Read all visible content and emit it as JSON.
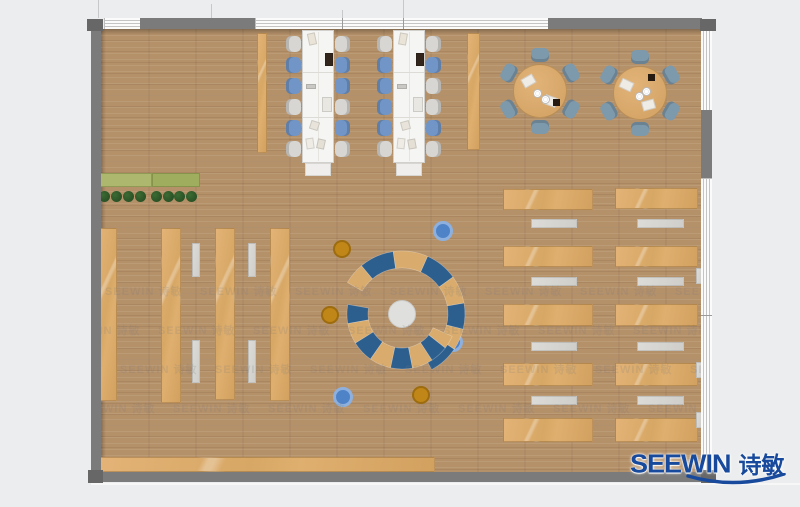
{
  "logo": {
    "text_en": "SEEWIN",
    "text_cn": "诗敏"
  },
  "watermark": {
    "text": "SEEWIN 诗敏",
    "step": 95,
    "count": 8,
    "rows": [
      {
        "y": 283,
        "x0": 10
      },
      {
        "y": 322,
        "x0": 63
      },
      {
        "y": 361,
        "x0": 25
      },
      {
        "y": 400,
        "x0": 78
      }
    ]
  },
  "colors": {
    "background": "#ecedee",
    "wall": "#7b7b7b",
    "wall_dark": "#676767",
    "window": "#fbfbfb",
    "window_line": "#c4c4c4",
    "floor": "#b5916a",
    "furniture_tan": "#dcab6d",
    "furniture_gray": "#d6d5d1",
    "table_white": "#f5f5f3",
    "table_border": "#d2d0cc",
    "chair_gray": "#d7d6d2",
    "chair_blue": "#7095c6",
    "round_chair_blue": "#7d99ac",
    "arc_blue": "#2d5f8e",
    "arc_tan": "#d9ab6c",
    "hub_gray": "#dfdfdd",
    "ottoman_blue": "#4f83c7",
    "ottoman_orange": "#c08617",
    "planter_green": "#a8b56c",
    "plant_green": "#2a5226",
    "logo_blue": "#17499c",
    "watermark_gray": "#7a7a7a"
  },
  "furniture": {
    "rects": [
      {
        "name": "side-bench",
        "x": 257,
        "y": 33,
        "w": 10,
        "h": 120
      },
      {
        "name": "side-bench",
        "x": 467,
        "y": 33,
        "w": 13,
        "h": 117
      },
      {
        "name": "bookshelf",
        "x": 98,
        "y": 228,
        "w": 19,
        "h": 173
      },
      {
        "name": "bookshelf",
        "x": 161,
        "y": 228,
        "w": 20,
        "h": 175
      },
      {
        "name": "bookshelf",
        "x": 215,
        "y": 228,
        "w": 20,
        "h": 172
      },
      {
        "name": "bookshelf",
        "x": 270,
        "y": 228,
        "w": 20,
        "h": 173
      },
      {
        "name": "desk-row",
        "x": 503,
        "y": 189,
        "w": 90,
        "h": 21
      },
      {
        "name": "desk-row",
        "x": 503,
        "y": 246,
        "w": 90,
        "h": 21
      },
      {
        "name": "desk-row",
        "x": 503,
        "y": 304,
        "w": 90,
        "h": 22
      },
      {
        "name": "desk-row",
        "x": 503,
        "y": 363,
        "w": 90,
        "h": 23
      },
      {
        "name": "desk-row",
        "x": 503,
        "y": 418,
        "w": 90,
        "h": 24
      },
      {
        "name": "desk-row",
        "x": 615,
        "y": 188,
        "w": 83,
        "h": 21
      },
      {
        "name": "desk-row",
        "x": 615,
        "y": 246,
        "w": 83,
        "h": 21
      },
      {
        "name": "desk-row",
        "x": 615,
        "y": 304,
        "w": 83,
        "h": 22
      },
      {
        "name": "desk-row",
        "x": 615,
        "y": 363,
        "w": 83,
        "h": 23
      },
      {
        "name": "desk-row",
        "x": 615,
        "y": 418,
        "w": 83,
        "h": 24
      },
      {
        "name": "bottom-bench",
        "x": 100,
        "y": 457,
        "w": 335,
        "h": 15
      }
    ],
    "gray_rects": [
      {
        "name": "reading-bench",
        "x": 192,
        "y": 243,
        "w": 8,
        "h": 34
      },
      {
        "name": "reading-bench",
        "x": 192,
        "y": 340,
        "w": 8,
        "h": 43
      },
      {
        "name": "reading-bench",
        "x": 248,
        "y": 243,
        "w": 8,
        "h": 34
      },
      {
        "name": "reading-bench",
        "x": 248,
        "y": 340,
        "w": 8,
        "h": 43
      },
      {
        "name": "reading-bench",
        "x": 531,
        "y": 219,
        "w": 46,
        "h": 9
      },
      {
        "name": "reading-bench",
        "x": 531,
        "y": 277,
        "w": 46,
        "h": 9
      },
      {
        "name": "reading-bench",
        "x": 531,
        "y": 342,
        "w": 46,
        "h": 9
      },
      {
        "name": "reading-bench",
        "x": 531,
        "y": 396,
        "w": 46,
        "h": 9
      },
      {
        "name": "reading-bench",
        "x": 637,
        "y": 219,
        "w": 47,
        "h": 9
      },
      {
        "name": "reading-bench",
        "x": 637,
        "y": 277,
        "w": 47,
        "h": 9
      },
      {
        "name": "reading-bench",
        "x": 637,
        "y": 342,
        "w": 47,
        "h": 9
      },
      {
        "name": "reading-bench",
        "x": 637,
        "y": 396,
        "w": 47,
        "h": 9
      },
      {
        "name": "wall-sill",
        "x": 696,
        "y": 268,
        "w": 6,
        "h": 16
      },
      {
        "name": "wall-sill",
        "x": 696,
        "y": 362,
        "w": 6,
        "h": 16
      },
      {
        "name": "wall-sill",
        "x": 696,
        "y": 412,
        "w": 6,
        "h": 16
      }
    ],
    "planter": {
      "x": 98,
      "y": 173,
      "w": 102,
      "h": 14,
      "seam_x": 152,
      "plants_cy": 196,
      "plant_r": 5.5,
      "plants_cx": [
        104,
        116,
        128,
        140,
        156,
        168,
        179,
        191
      ]
    },
    "long_tables": [
      {
        "x": 302,
        "y": 30,
        "w": 32,
        "h": 133,
        "seams": [
          42,
          87
        ],
        "chair_ys": [
          36,
          57,
          78,
          99,
          120,
          141
        ],
        "chairs_left": {
          "x": 286,
          "colors": [
            "g",
            "b",
            "b",
            "g",
            "b",
            "g"
          ]
        },
        "chairs_right": {
          "x": 335,
          "colors": [
            "g",
            "b",
            "b",
            "g",
            "b",
            "g"
          ]
        },
        "items": [
          {
            "x": 308,
            "y": 33,
            "w": 8,
            "h": 12,
            "c": "#eae4d8",
            "r": -12
          },
          {
            "x": 325,
            "y": 53,
            "w": 8,
            "h": 13,
            "c": "#32251b",
            "r": 0
          },
          {
            "x": 306,
            "y": 84,
            "w": 10,
            "h": 5,
            "c": "#c9c8c4",
            "r": 0
          },
          {
            "x": 322,
            "y": 97,
            "w": 10,
            "h": 15,
            "c": "#e9e7e2",
            "r": 0
          },
          {
            "x": 310,
            "y": 121,
            "w": 9,
            "h": 9,
            "c": "#e8e4db",
            "r": 18
          },
          {
            "x": 306,
            "y": 138,
            "w": 8,
            "h": 11,
            "c": "#efece5",
            "r": -8
          },
          {
            "x": 317,
            "y": 139,
            "w": 8,
            "h": 10,
            "c": "#e4e0d6",
            "r": 12
          }
        ]
      },
      {
        "x": 393,
        "y": 30,
        "w": 32,
        "h": 133,
        "seams": [
          42,
          87
        ],
        "chair_ys": [
          36,
          57,
          78,
          99,
          120,
          141
        ],
        "chairs_left": {
          "x": 377,
          "colors": [
            "g",
            "b",
            "b",
            "b",
            "b",
            "g"
          ]
        },
        "chairs_right": {
          "x": 426,
          "colors": [
            "g",
            "b",
            "g",
            "g",
            "b",
            "g"
          ]
        },
        "items": [
          {
            "x": 399,
            "y": 33,
            "w": 8,
            "h": 12,
            "c": "#eae4d8",
            "r": 10
          },
          {
            "x": 416,
            "y": 53,
            "w": 8,
            "h": 13,
            "c": "#32251b",
            "r": 0
          },
          {
            "x": 397,
            "y": 84,
            "w": 10,
            "h": 5,
            "c": "#c9c8c4",
            "r": 0
          },
          {
            "x": 413,
            "y": 97,
            "w": 10,
            "h": 15,
            "c": "#e9e7e2",
            "r": 0
          },
          {
            "x": 401,
            "y": 121,
            "w": 9,
            "h": 9,
            "c": "#e8e4db",
            "r": -15
          },
          {
            "x": 397,
            "y": 138,
            "w": 8,
            "h": 11,
            "c": "#efece5",
            "r": 6
          },
          {
            "x": 408,
            "y": 139,
            "w": 8,
            "h": 10,
            "c": "#e4e0d6",
            "r": -10
          }
        ]
      }
    ],
    "round_tables": [
      {
        "cx": 540,
        "cy": 91,
        "r": 27,
        "chair_dist": 36,
        "chair_angles": [
          -90,
          -150,
          -30,
          30,
          90,
          150
        ],
        "deco": [
          {
            "t": "book",
            "dx": -12,
            "dy": -10,
            "rot": -30
          },
          {
            "t": "book",
            "dx": 10,
            "dy": 10,
            "rot": 20
          },
          {
            "t": "plate",
            "dx": -3,
            "dy": 2
          },
          {
            "t": "plate",
            "dx": 5,
            "dy": 8
          },
          {
            "t": "dark",
            "dx": 16,
            "dy": 11
          }
        ]
      },
      {
        "cx": 640,
        "cy": 93,
        "r": 27,
        "chair_dist": 36,
        "chair_angles": [
          -90,
          -150,
          -30,
          30,
          90,
          150
        ],
        "deco": [
          {
            "t": "book",
            "dx": -14,
            "dy": -8,
            "rot": 25
          },
          {
            "t": "book",
            "dx": 8,
            "dy": 12,
            "rot": -15
          },
          {
            "t": "plate",
            "dx": -1,
            "dy": 3
          },
          {
            "t": "plate",
            "dx": 6,
            "dy": -2
          },
          {
            "t": "dark",
            "dx": 11,
            "dy": -16
          }
        ]
      }
    ],
    "circle_feature": {
      "cx": 402,
      "cy": 314,
      "hub_r": 14,
      "rings": [
        {
          "r0": 46,
          "r1": 63,
          "segs": [
            [
              150,
              130,
              "tan"
            ],
            [
              130,
              98,
              "blue"
            ],
            [
              98,
              66,
              "tan"
            ],
            [
              66,
              36,
              "blue"
            ],
            [
              36,
              10,
              "tan"
            ],
            [
              10,
              -14,
              "blue"
            ],
            [
              -14,
              -34,
              "tan"
            ],
            [
              -34,
              -62,
              "blue"
            ]
          ]
        },
        {
          "r0": 34,
          "r1": 55,
          "segs": [
            [
              170,
              190,
              "blue"
            ],
            [
              190,
              212,
              "tan"
            ],
            [
              212,
              235,
              "blue"
            ],
            [
              235,
              258,
              "tan"
            ],
            [
              258,
              281,
              "blue"
            ],
            [
              281,
              303,
              "tan"
            ],
            [
              303,
              322,
              "blue"
            ],
            [
              322,
              336,
              "tan"
            ]
          ]
        }
      ]
    },
    "ottomans": [
      {
        "cx": 443,
        "cy": 231,
        "r": 10,
        "c": "blue"
      },
      {
        "cx": 453,
        "cy": 342,
        "r": 10,
        "c": "blue"
      },
      {
        "cx": 343,
        "cy": 397,
        "r": 10,
        "c": "blue"
      },
      {
        "cx": 342,
        "cy": 249,
        "r": 9,
        "c": "orange"
      },
      {
        "cx": 330,
        "cy": 315,
        "r": 9,
        "c": "orange"
      },
      {
        "cx": 421,
        "cy": 395,
        "r": 9,
        "c": "orange"
      }
    ]
  }
}
